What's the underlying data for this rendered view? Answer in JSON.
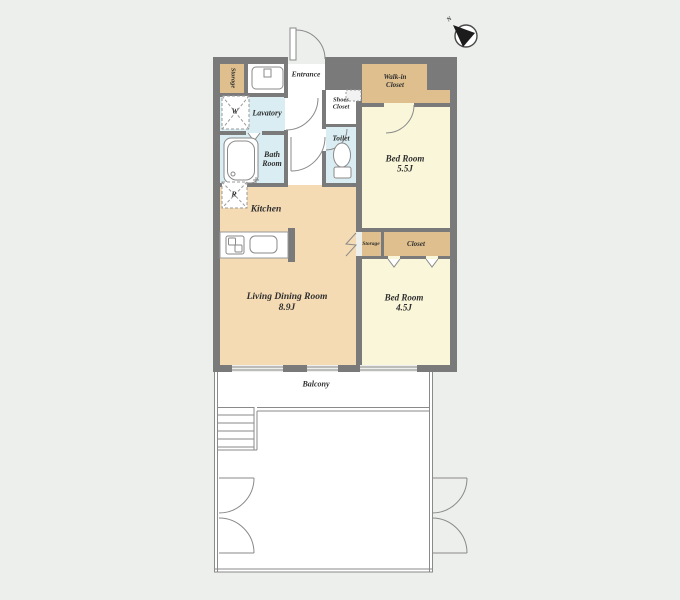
{
  "colors": {
    "background": "#edefec",
    "wall": "#7a7a7a",
    "ldk_floor": "#f4dbb4",
    "bedroom_floor": "#faf6d9",
    "closet_floor": "#debf8d",
    "wet_floor": "#d9edf2",
    "line": "#8a8a8a",
    "compass_dark": "#1c1c1c"
  },
  "compass": {
    "north_label": "N"
  },
  "rooms": {
    "entrance": {
      "label": "Entrance"
    },
    "entry_storage": {
      "label": "Storage"
    },
    "lavatory": {
      "label": "Lavatory"
    },
    "shoes_closet": {
      "line1": "Shoes",
      "line2": "Closet"
    },
    "toilet": {
      "label": "Toilet"
    },
    "bath_room": {
      "line1": "Bath",
      "line2": "Room"
    },
    "walk_in_closet": {
      "line1": "Walk-in",
      "line2": "Closet"
    },
    "bedroom_55": {
      "name": "Bed Room",
      "area": "5.5J"
    },
    "kitchen": {
      "label": "Kitchen"
    },
    "mid_storage": {
      "label": "Storage"
    },
    "closet": {
      "label": "Closet"
    },
    "bedroom_45": {
      "name": "Bed Room",
      "area": "4.5J"
    },
    "living_dining": {
      "name": "Living Dining Room",
      "area": "8.9J"
    },
    "balcony": {
      "label": "Balcony"
    }
  },
  "markers": {
    "washing_machine": "W",
    "refrigerator": "R"
  }
}
